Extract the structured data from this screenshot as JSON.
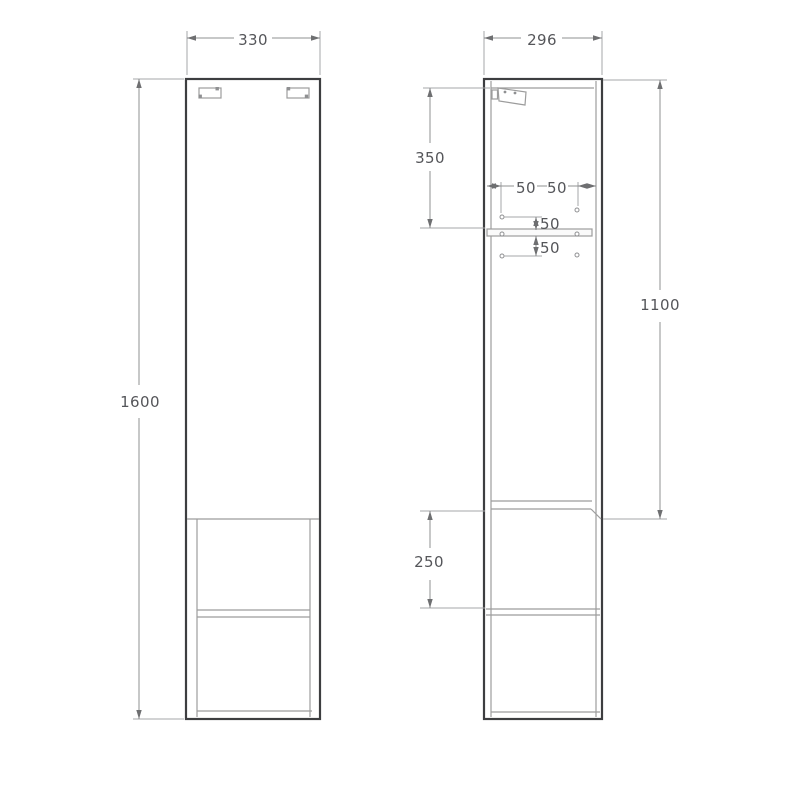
{
  "page": {
    "kind": "furniture technical drawing",
    "subject": "tall wall-hung cabinet, front and side orthographic views with dimensions"
  },
  "colors": {
    "background": "#ffffff",
    "cabinet_outline": "#3d3e40",
    "inner_detail": "#9c9c9c",
    "dimension_lines": "#8f9092",
    "dimension_text": "#55565a"
  },
  "views": {
    "front": {
      "name": "front view",
      "dims": {
        "width": "330",
        "height": "1600"
      }
    },
    "side": {
      "name": "side view",
      "dims": {
        "depth": "296",
        "top_to_shelf": "350",
        "pin_left": "50",
        "pin_right": "50",
        "pin_above_shelf": "50",
        "pin_below_shelf": "50",
        "top_to_door_bottom": "1100",
        "door_bottom_to_shelf": "250"
      }
    }
  }
}
